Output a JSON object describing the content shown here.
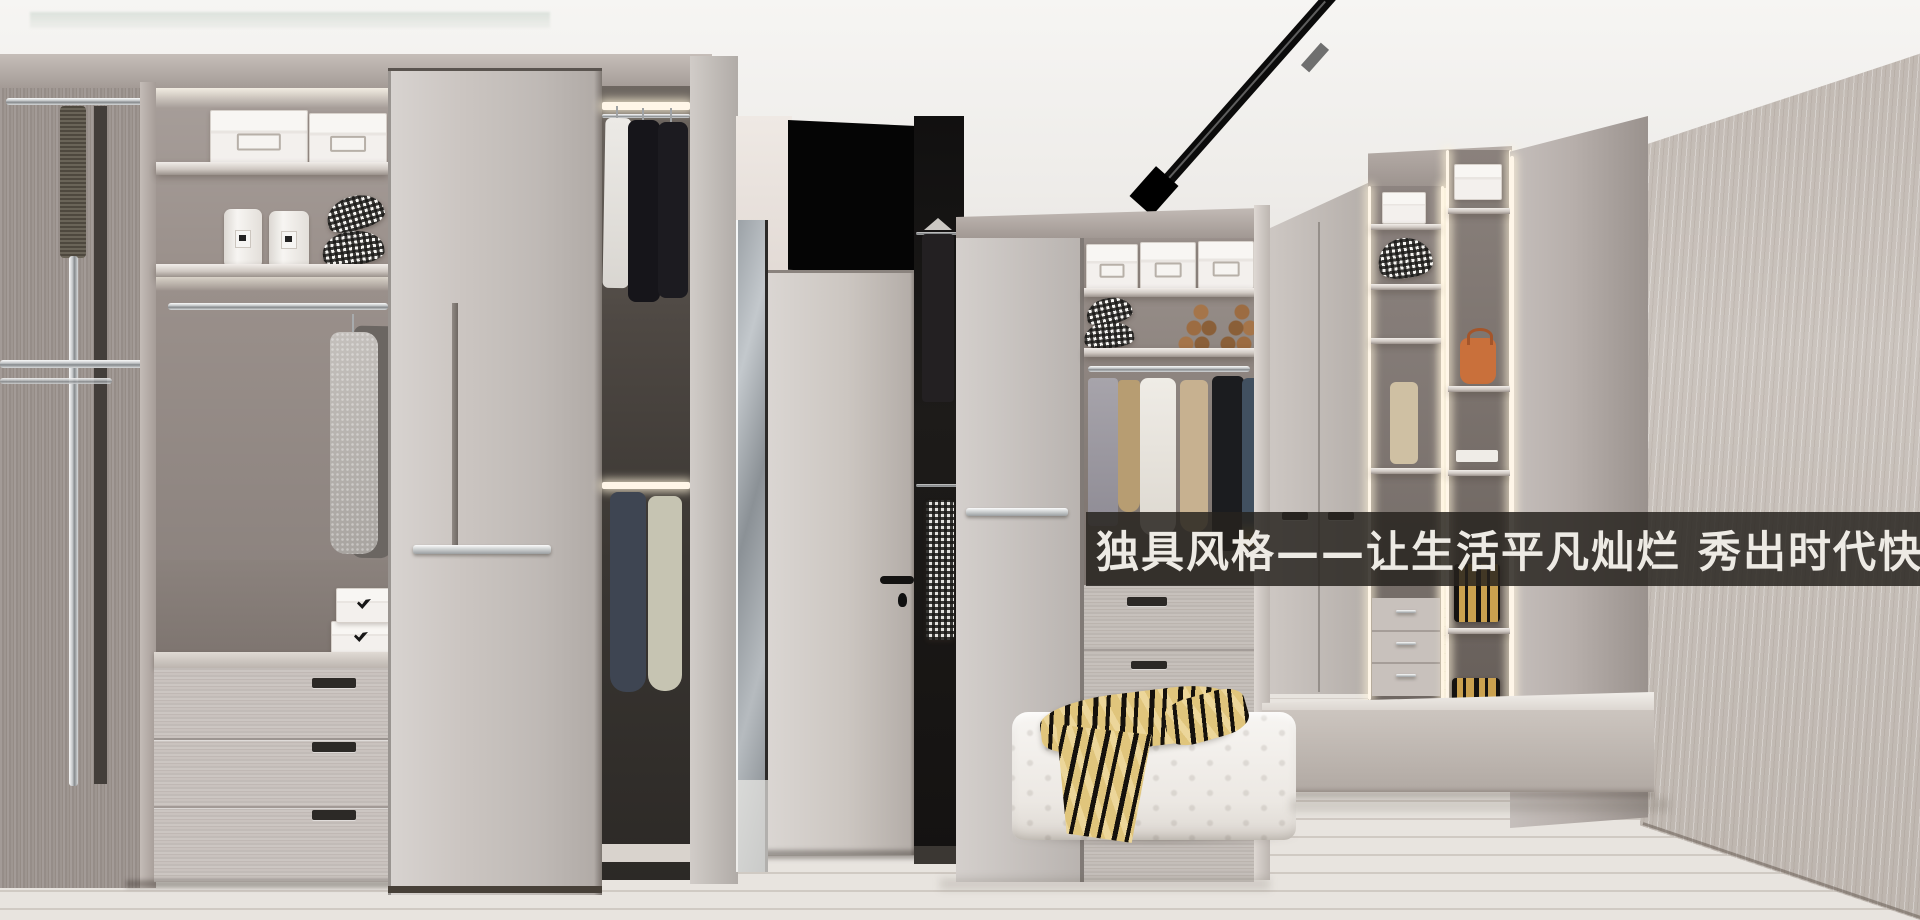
{
  "banner": {
    "text": "独具风格——让生活平凡灿烂 秀出时代快乐！"
  },
  "palette": {
    "ceiling": "#f4f2ef",
    "wood_light": "#c9c3bf",
    "wood_mid": "#a89f9a",
    "wood_dark": "#6e6662",
    "interior_dark": "#1b1917",
    "crown": "#b4aca7",
    "chrome": "#e9eaea",
    "floor": "#e8e4df",
    "floor_line": "#b9b2ab",
    "wallpaper": "#ccc5bf",
    "ottoman": "#f3f1ed",
    "throw_gold": "#e0c57c",
    "throw_black": "#15110c",
    "banner_bg": "rgba(38,34,30,0.84)",
    "banner_text": "#edeae4",
    "led": "#fff6e8",
    "track_light": "#0b0b0b"
  }
}
